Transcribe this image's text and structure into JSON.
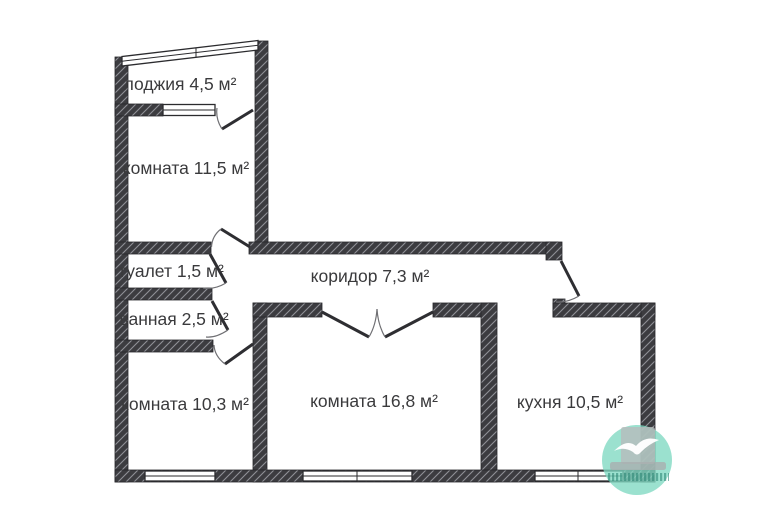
{
  "floorplan": {
    "type": "apartment-floor-plan",
    "rooms": [
      {
        "id": "loggia",
        "label": "лоджия 4,5 м²"
      },
      {
        "id": "room-a",
        "label": "комната 11,5 м²"
      },
      {
        "id": "toilet",
        "label": "туалет 1,5 м²"
      },
      {
        "id": "bathroom",
        "label": "ванная 2,5 м²"
      },
      {
        "id": "corridor",
        "label": "коридор 7,3 м²"
      },
      {
        "id": "room-b",
        "label": "комната 10,3 м²"
      },
      {
        "id": "room-c",
        "label": "комната 16,8 м²"
      },
      {
        "id": "kitchen",
        "label": "кухня 10,5 м²"
      }
    ],
    "colors": {
      "wall_fill": "#3c3c40",
      "wall_hatch": "#8f9096",
      "label_text": "#3a3a3c",
      "background": "#ffffff",
      "watermark_teal": "#7fd8c2",
      "watermark_gray": "#b7bcbc"
    }
  }
}
